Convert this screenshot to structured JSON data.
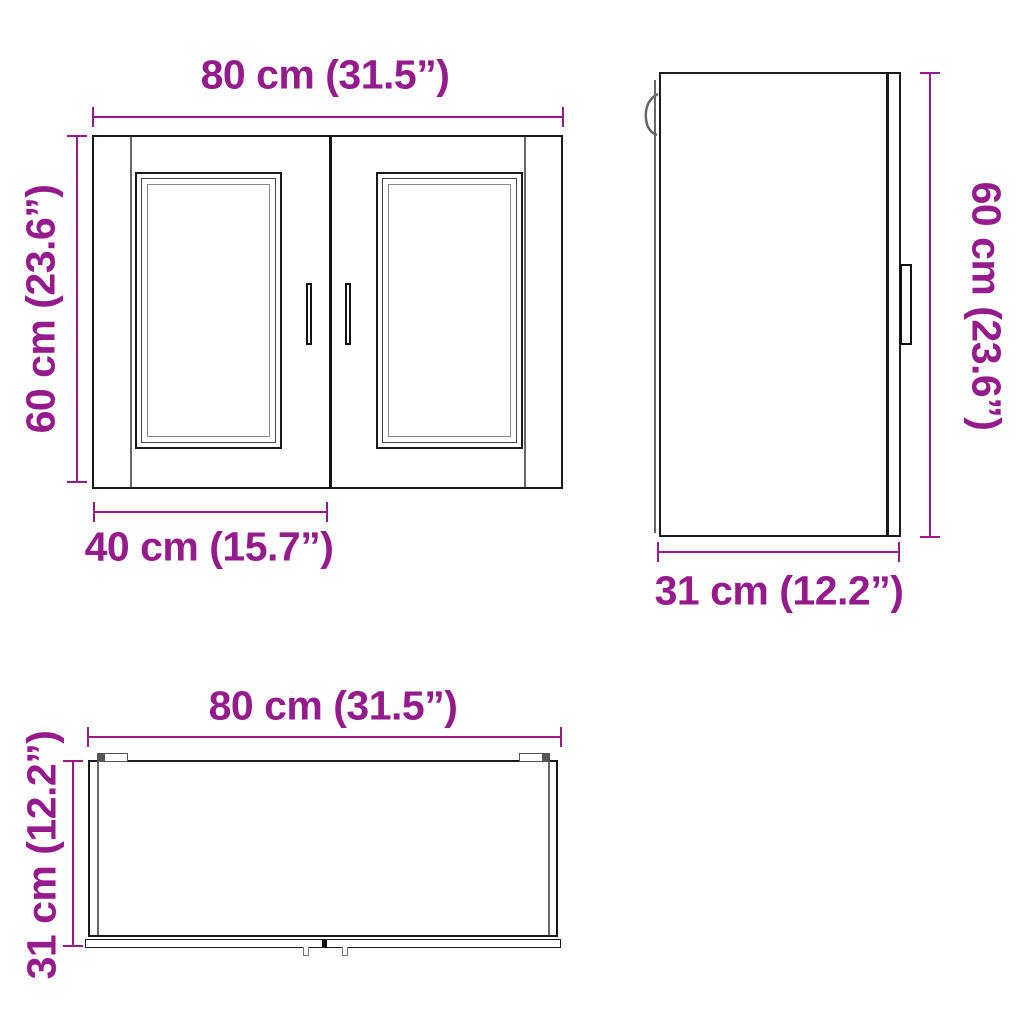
{
  "colors": {
    "accent": "#951a8c",
    "line": "#1a1a1a"
  },
  "views": {
    "front": {
      "width_label": "80 cm (31.5”)",
      "height_label": "60 cm (23.6”)",
      "door_width_label": "40 cm (15.7”)"
    },
    "side": {
      "height_label": "60 cm (23.6”)",
      "depth_label": "31 cm (12.2”)"
    },
    "top": {
      "width_label": "80 cm (31.5”)",
      "depth_label": "31 cm (12.2”)"
    }
  }
}
